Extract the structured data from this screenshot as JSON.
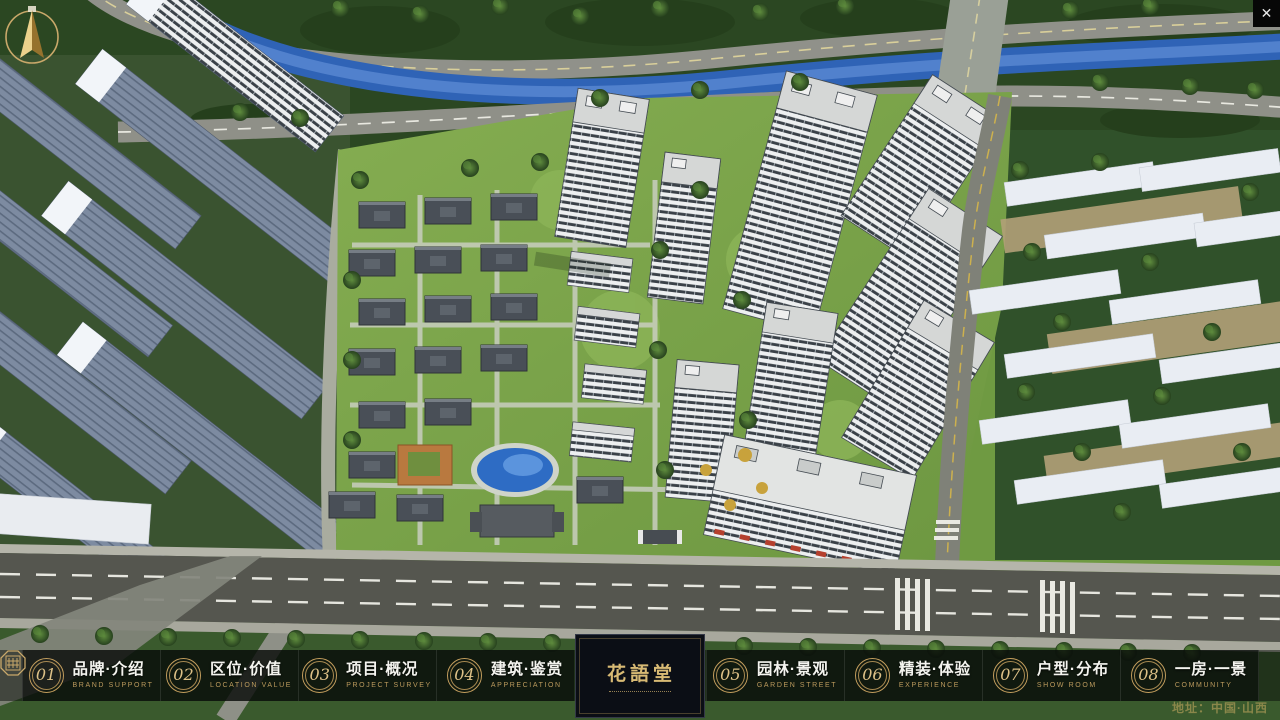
{
  "theme": {
    "gold": "#c9a66a",
    "bar_background": "rgba(12,16,12,0.52)",
    "panel_background": "rgba(6,10,8,0.62)",
    "logo_background": "#0b0e15",
    "label_white": "#f4f4ef",
    "subtitle_gold": "#bb9a5d"
  },
  "icons": {
    "close": "✕",
    "compass": "north-arrow",
    "logo_seal": "hua-yu-tang-seal"
  },
  "nav": {
    "items": [
      {
        "num": "01",
        "zh": "品牌·介绍",
        "en": "BRAND SUPPORT"
      },
      {
        "num": "02",
        "zh": "区位·价值",
        "en": "LOCATION VALUE"
      },
      {
        "num": "03",
        "zh": "项目·概况",
        "en": "PROJECT SURVEY"
      },
      {
        "num": "04",
        "zh": "建筑·鉴赏",
        "en": "APPRECIATION"
      },
      {
        "num": "05",
        "zh": "园林·景观",
        "en": "GARDEN STREET"
      },
      {
        "num": "06",
        "zh": "精装·体验",
        "en": "EXPERIENCE"
      },
      {
        "num": "07",
        "zh": "户型·分布",
        "en": "SHOW ROOM"
      },
      {
        "num": "08",
        "zh": "一房·一景",
        "en": "COMMUNITY"
      }
    ],
    "logo": {
      "title": "花語堂"
    }
  },
  "footer": {
    "address": "地址：中国·山西"
  }
}
